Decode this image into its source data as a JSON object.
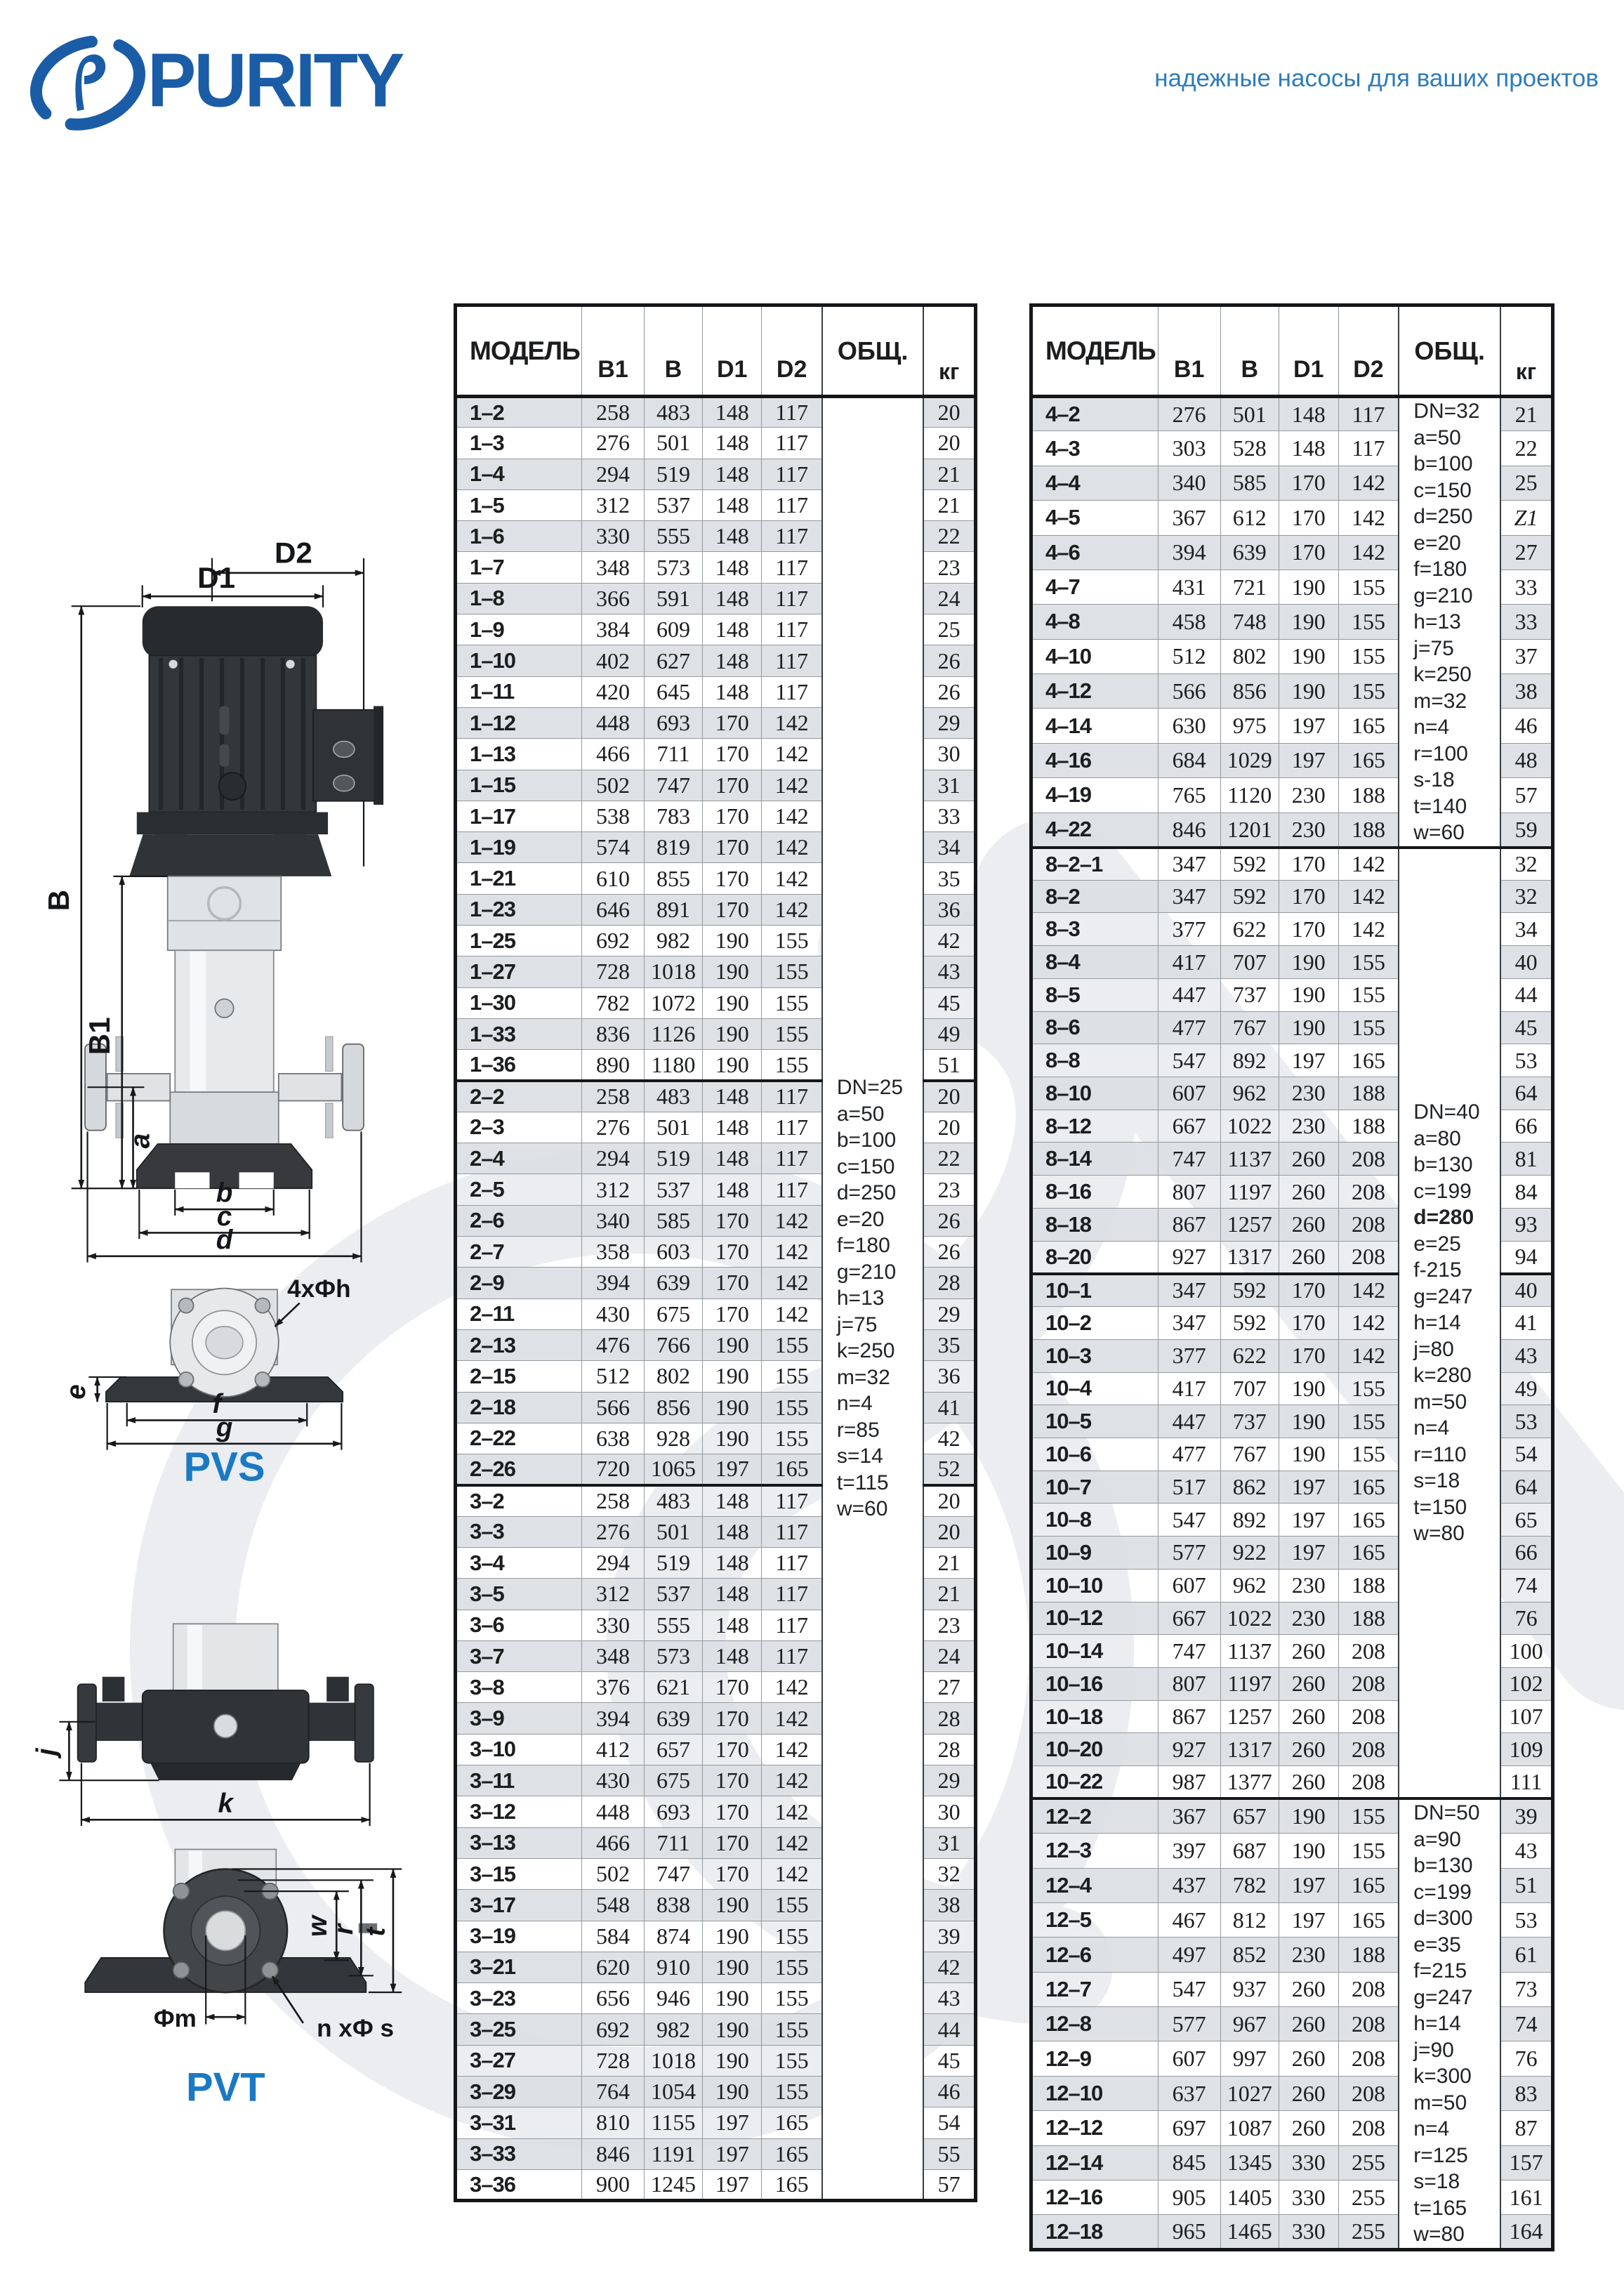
{
  "header": {
    "brand": "PURITY",
    "tagline": "надежные насосы для ваших проектов"
  },
  "tables": [
    {
      "id": "left",
      "columns": {
        "model": "МОДЕЛЬ",
        "b1": "B1",
        "b": "B",
        "d1": "D1",
        "d2": "D2",
        "obsh": "ОБЩ.",
        "kg": "кг"
      },
      "groups": [
        {
          "rows": [
            [
              "1–2",
              258,
              483,
              148,
              117,
              20
            ],
            [
              "1–3",
              276,
              501,
              148,
              117,
              20
            ],
            [
              "1–4",
              294,
              519,
              148,
              117,
              21
            ],
            [
              "1–5",
              312,
              537,
              148,
              117,
              21
            ],
            [
              "1–6",
              330,
              555,
              148,
              117,
              22
            ],
            [
              "1–7",
              348,
              573,
              148,
              117,
              23
            ],
            [
              "1–8",
              366,
              591,
              148,
              117,
              24
            ],
            [
              "1–9",
              384,
              609,
              148,
              117,
              25
            ],
            [
              "1–10",
              402,
              627,
              148,
              117,
              26
            ],
            [
              "1–11",
              420,
              645,
              148,
              117,
              26
            ],
            [
              "1–12",
              448,
              693,
              170,
              142,
              29
            ],
            [
              "1–13",
              466,
              711,
              170,
              142,
              30
            ],
            [
              "1–15",
              502,
              747,
              170,
              142,
              31
            ],
            [
              "1–17",
              538,
              783,
              170,
              142,
              33
            ],
            [
              "1–19",
              574,
              819,
              170,
              142,
              34
            ],
            [
              "1–21",
              610,
              855,
              170,
              142,
              35
            ],
            [
              "1–23",
              646,
              891,
              170,
              142,
              36
            ],
            [
              "1–25",
              692,
              982,
              190,
              155,
              42
            ],
            [
              "1–27",
              728,
              1018,
              190,
              155,
              43
            ],
            [
              "1–30",
              782,
              1072,
              190,
              155,
              45
            ],
            [
              "1–33",
              836,
              1126,
              190,
              155,
              49
            ],
            [
              "1–36",
              890,
              1180,
              190,
              155,
              51
            ]
          ]
        },
        {
          "rows": [
            [
              "2–2",
              258,
              483,
              148,
              117,
              20
            ],
            [
              "2–3",
              276,
              501,
              148,
              117,
              20
            ],
            [
              "2–4",
              294,
              519,
              148,
              117,
              22
            ],
            [
              "2–5",
              312,
              537,
              148,
              117,
              23
            ],
            [
              "2–6",
              340,
              585,
              170,
              142,
              26
            ],
            [
              "2–7",
              358,
              603,
              170,
              142,
              26
            ],
            [
              "2–9",
              394,
              639,
              170,
              142,
              28
            ],
            [
              "2–11",
              430,
              675,
              170,
              142,
              29
            ],
            [
              "2–13",
              476,
              766,
              190,
              155,
              35
            ],
            [
              "2–15",
              512,
              802,
              190,
              155,
              36
            ],
            [
              "2–18",
              566,
              856,
              190,
              155,
              41
            ],
            [
              "2–22",
              638,
              928,
              190,
              155,
              42
            ],
            [
              "2–26",
              720,
              1065,
              197,
              165,
              52
            ]
          ]
        },
        {
          "rows": [
            [
              "3–2",
              258,
              483,
              148,
              117,
              20
            ],
            [
              "3–3",
              276,
              501,
              148,
              117,
              20
            ],
            [
              "3–4",
              294,
              519,
              148,
              117,
              21
            ],
            [
              "3–5",
              312,
              537,
              148,
              117,
              21
            ],
            [
              "3–6",
              330,
              555,
              148,
              117,
              23
            ],
            [
              "3–7",
              348,
              573,
              148,
              117,
              24
            ],
            [
              "3–8",
              376,
              621,
              170,
              142,
              27
            ],
            [
              "3–9",
              394,
              639,
              170,
              142,
              28
            ],
            [
              "3–10",
              412,
              657,
              170,
              142,
              28
            ],
            [
              "3–11",
              430,
              675,
              170,
              142,
              29
            ],
            [
              "3–12",
              448,
              693,
              170,
              142,
              30
            ],
            [
              "3–13",
              466,
              711,
              170,
              142,
              31
            ],
            [
              "3–15",
              502,
              747,
              170,
              142,
              32
            ],
            [
              "3–17",
              548,
              838,
              190,
              155,
              38
            ],
            [
              "3–19",
              584,
              874,
              190,
              155,
              39
            ],
            [
              "3–21",
              620,
              910,
              190,
              155,
              42
            ],
            [
              "3–23",
              656,
              946,
              190,
              155,
              43
            ],
            [
              "3–25",
              692,
              982,
              190,
              155,
              44
            ],
            [
              "3–27",
              728,
              1018,
              190,
              155,
              45
            ],
            [
              "3–29",
              764,
              1054,
              190,
              155,
              46
            ],
            [
              "3–31",
              810,
              1155,
              197,
              165,
              54
            ],
            [
              "3–33",
              846,
              1191,
              197,
              165,
              55
            ],
            [
              "3–36",
              900,
              1245,
              197,
              165,
              57
            ]
          ]
        }
      ],
      "note_blocks": [
        {
          "groups": [
            0,
            1,
            2
          ],
          "lines": [
            "DN=25",
            "a=50",
            "b=100",
            "c=150",
            "d=250",
            "e=20",
            "f=180",
            "g=210",
            "h=13",
            "j=75",
            "k=250",
            "m=32",
            "n=4",
            "r=85",
            "s=14",
            "t=115",
            "w=60"
          ],
          "bold_lines": []
        }
      ]
    },
    {
      "id": "right",
      "columns": {
        "model": "МОДЕЛЬ",
        "b1": "B1",
        "b": "B",
        "d1": "D1",
        "d2": "D2",
        "obsh": "ОБЩ.",
        "kg": "кг"
      },
      "groups": [
        {
          "rows": [
            [
              "4–2",
              276,
              501,
              148,
              117,
              21
            ],
            [
              "4–3",
              303,
              528,
              148,
              117,
              22
            ],
            [
              "4–4",
              340,
              585,
              170,
              142,
              25
            ],
            [
              "4–5",
              367,
              612,
              170,
              142,
              "Z1"
            ],
            [
              "4–6",
              394,
              639,
              170,
              142,
              27
            ],
            [
              "4–7",
              431,
              721,
              190,
              155,
              33
            ],
            [
              "4–8",
              458,
              748,
              190,
              155,
              33
            ],
            [
              "4–10",
              512,
              802,
              190,
              155,
              37
            ],
            [
              "4–12",
              566,
              856,
              190,
              155,
              38
            ],
            [
              "4–14",
              630,
              975,
              197,
              165,
              46
            ],
            [
              "4–16",
              684,
              1029,
              197,
              165,
              48
            ],
            [
              "4–19",
              765,
              1120,
              230,
              188,
              57
            ],
            [
              "4–22",
              846,
              1201,
              230,
              188,
              59
            ]
          ]
        },
        {
          "rows": [
            [
              "8–2–1",
              347,
              592,
              170,
              142,
              32
            ],
            [
              "8–2",
              347,
              592,
              170,
              142,
              32
            ],
            [
              "8–3",
              377,
              622,
              170,
              142,
              34
            ],
            [
              "8–4",
              417,
              707,
              190,
              155,
              40
            ],
            [
              "8–5",
              447,
              737,
              190,
              155,
              44
            ],
            [
              "8–6",
              477,
              767,
              190,
              155,
              45
            ],
            [
              "8–8",
              547,
              892,
              197,
              165,
              53
            ],
            [
              "8–10",
              607,
              962,
              230,
              188,
              64
            ],
            [
              "8–12",
              667,
              1022,
              230,
              188,
              66
            ],
            [
              "8–14",
              747,
              1137,
              260,
              208,
              81
            ],
            [
              "8–16",
              807,
              1197,
              260,
              208,
              84
            ],
            [
              "8–18",
              867,
              1257,
              260,
              208,
              93
            ],
            [
              "8–20",
              927,
              1317,
              260,
              208,
              94
            ]
          ]
        },
        {
          "rows": [
            [
              "10–1",
              347,
              592,
              170,
              142,
              40
            ],
            [
              "10–2",
              347,
              592,
              170,
              142,
              41
            ],
            [
              "10–3",
              377,
              622,
              170,
              142,
              43
            ],
            [
              "10–4",
              417,
              707,
              190,
              155,
              49
            ],
            [
              "10–5",
              447,
              737,
              190,
              155,
              53
            ],
            [
              "10–6",
              477,
              767,
              190,
              155,
              54
            ],
            [
              "10–7",
              517,
              862,
              197,
              165,
              64
            ],
            [
              "10–8",
              547,
              892,
              197,
              165,
              65
            ],
            [
              "10–9",
              577,
              922,
              197,
              165,
              66
            ],
            [
              "10–10",
              607,
              962,
              230,
              188,
              74
            ],
            [
              "10–12",
              667,
              1022,
              230,
              188,
              76
            ],
            [
              "10–14",
              747,
              1137,
              260,
              208,
              100
            ],
            [
              "10–16",
              807,
              1197,
              260,
              208,
              102
            ],
            [
              "10–18",
              867,
              1257,
              260,
              208,
              107
            ],
            [
              "10–20",
              927,
              1317,
              260,
              208,
              109
            ],
            [
              "10–22",
              987,
              1377,
              260,
              208,
              111
            ]
          ]
        },
        {
          "rows": [
            [
              "12–2",
              367,
              657,
              190,
              155,
              39
            ],
            [
              "12–3",
              397,
              687,
              190,
              155,
              43
            ],
            [
              "12–4",
              437,
              782,
              197,
              165,
              51
            ],
            [
              "12–5",
              467,
              812,
              197,
              165,
              53
            ],
            [
              "12–6",
              497,
              852,
              230,
              188,
              61
            ],
            [
              "12–7",
              547,
              937,
              260,
              208,
              73
            ],
            [
              "12–8",
              577,
              967,
              260,
              208,
              74
            ],
            [
              "12–9",
              607,
              997,
              260,
              208,
              76
            ],
            [
              "12–10",
              637,
              1027,
              260,
              208,
              83
            ],
            [
              "12–12",
              697,
              1087,
              260,
              208,
              87
            ],
            [
              "12–14",
              845,
              1345,
              330,
              255,
              157
            ],
            [
              "12–16",
              905,
              1405,
              330,
              255,
              161
            ],
            [
              "12–18",
              965,
              1465,
              330,
              255,
              164
            ]
          ]
        }
      ],
      "note_blocks": [
        {
          "groups": [
            0
          ],
          "lines": [
            "DN=32",
            "a=50",
            "b=100",
            "c=150",
            "d=250",
            "e=20",
            "f=180",
            "g=210",
            "h=13",
            "j=75",
            "k=250",
            "m=32",
            "n=4",
            "r=100",
            "s-18",
            "t=140",
            "w=60"
          ],
          "bold_lines": []
        },
        {
          "groups": [
            1,
            2
          ],
          "lines": [
            "DN=40",
            "a=80",
            "b=130",
            "c=199",
            "d=280",
            "e=25",
            "f-215",
            "g=247",
            "h=14",
            "j=80",
            "k=280",
            "m=50",
            "n=4",
            "r=110",
            "s=18",
            "t=150",
            "w=80"
          ],
          "bold_lines": [
            "d=280"
          ]
        },
        {
          "groups": [
            3
          ],
          "lines": [
            "DN=50",
            "a=90",
            "b=130",
            "c=199",
            "d=300",
            "e=35",
            "f=215",
            "g=247",
            "h=14",
            "j=90",
            "k=300",
            "m=50",
            "n=4",
            "r=125",
            "s=18",
            "t=165",
            "w=80"
          ],
          "bold_lines": []
        }
      ]
    }
  ],
  "diagrams": {
    "pvs": {
      "label": "PVS",
      "dims": {
        "D1": "D1",
        "D2": "D2",
        "B": "B",
        "B1": "B1",
        "a": "a",
        "b": "b",
        "c": "c",
        "d": "d",
        "e": "e",
        "f": "f",
        "g": "g",
        "holes": "4xФh"
      }
    },
    "pvt": {
      "label": "PVT",
      "dims": {
        "j": "j",
        "k": "k",
        "w": "w",
        "r": "r",
        "t": "t",
        "m": "Фm",
        "holes": "n xФ s"
      }
    }
  }
}
